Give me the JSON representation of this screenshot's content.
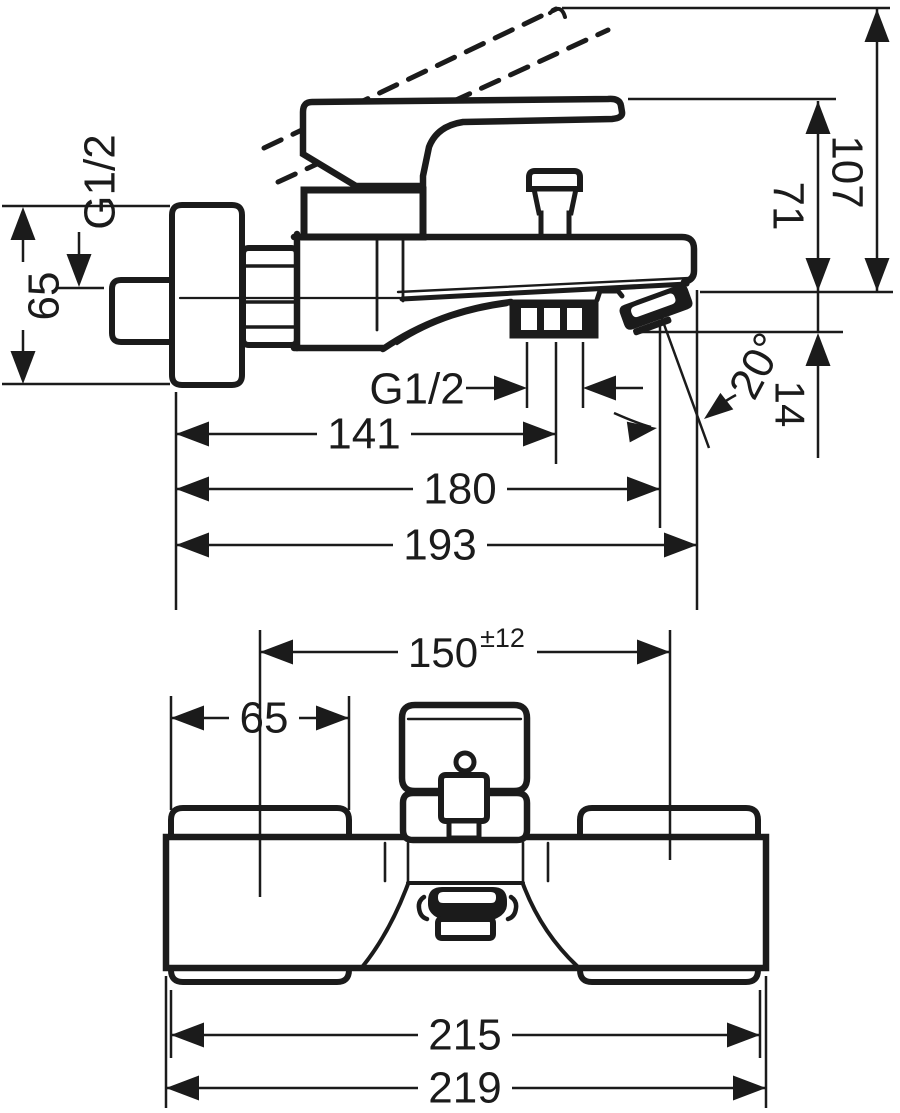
{
  "page": {
    "title": "Bath mixer technical dimension drawing",
    "background_color": "#ffffff",
    "ink_color": "#1b1b1b"
  },
  "drawing": {
    "side_view": {
      "name": "bath-mixer-side-elevation",
      "dimensions_mm": [
        "G1/2",
        "65",
        "71",
        "107",
        "14",
        "20°",
        "G1/2",
        "141",
        "180",
        "193"
      ],
      "labels": [
        {
          "id": "label-g12-wall-inlet",
          "text": "G1/2",
          "x": 100,
          "y": 182,
          "rot": -90,
          "size": 44,
          "anchor": "middle"
        },
        {
          "id": "label-dim-65-side",
          "text": "65",
          "x": 44,
          "y": 296,
          "rot": -90,
          "size": 44,
          "anchor": "middle"
        },
        {
          "id": "label-dim-71",
          "text": "71",
          "x": 788,
          "y": 206,
          "rot": 90,
          "size": 44,
          "anchor": "middle"
        },
        {
          "id": "label-dim-107",
          "text": "107",
          "x": 847,
          "y": 172,
          "rot": 90,
          "size": 44,
          "anchor": "middle"
        },
        {
          "id": "label-dim-14",
          "text": "14",
          "x": 790,
          "y": 404,
          "rot": 90,
          "size": 42,
          "anchor": "middle"
        },
        {
          "id": "label-angle-20",
          "text": "20°",
          "x": 757,
          "y": 366,
          "rot": -62,
          "size": 44,
          "anchor": "middle"
        },
        {
          "id": "label-g12-hose-outlet",
          "text": "G1/2",
          "x": 417,
          "y": 389,
          "rot": 0,
          "size": 44,
          "anchor": "middle"
        },
        {
          "id": "label-dim-141",
          "text": "141",
          "x": 364,
          "y": 434,
          "rot": 0,
          "size": 44,
          "anchor": "middle"
        },
        {
          "id": "label-dim-180",
          "text": "180",
          "x": 460,
          "y": 489,
          "rot": 0,
          "size": 44,
          "anchor": "middle"
        },
        {
          "id": "label-dim-193",
          "text": "193",
          "x": 440,
          "y": 545,
          "rot": 0,
          "size": 44,
          "anchor": "middle"
        }
      ]
    },
    "plan_view": {
      "name": "bath-mixer-front-view",
      "dimensions_mm": [
        "150±12",
        "65",
        "215",
        "219"
      ],
      "labels": [
        {
          "id": "label-dim-150",
          "text": "150",
          "sup": "±12",
          "x": 408,
          "y": 652,
          "rot": 0,
          "size": 42,
          "sup_size": 27,
          "anchor": "start"
        },
        {
          "id": "label-dim-65-plan",
          "text": "65",
          "x": 264,
          "y": 718,
          "rot": 0,
          "size": 44,
          "anchor": "middle"
        },
        {
          "id": "label-dim-215",
          "text": "215",
          "x": 465,
          "y": 1035,
          "rot": 0,
          "size": 44,
          "anchor": "middle"
        },
        {
          "id": "label-dim-219",
          "text": "219",
          "x": 465,
          "y": 1088,
          "rot": 0,
          "size": 44,
          "anchor": "middle"
        }
      ]
    }
  }
}
